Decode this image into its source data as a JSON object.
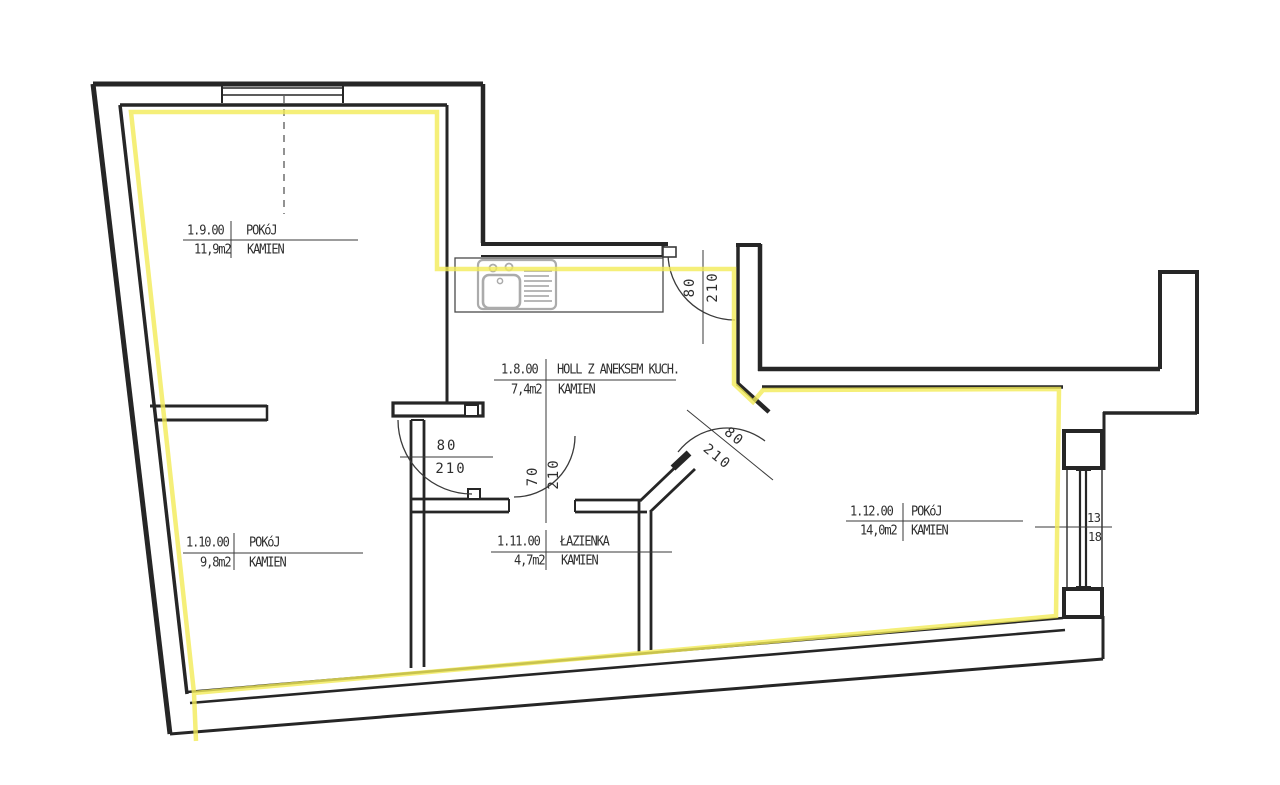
{
  "drawing_type": "apartment floor plan",
  "colors": {
    "wall": "#262626",
    "thin_line": "#3a3a3a",
    "highlight": "#f3eb58",
    "text": "#2e2e2e",
    "fixture": "#ababab"
  },
  "rooms": [
    {
      "id": "1.9.00",
      "name": "POKóJ",
      "area": "11,9m2",
      "material": "KAMIEN"
    },
    {
      "id": "1.10.00",
      "name": "POKóJ",
      "area": "9,8m2",
      "material": "KAMIEN"
    },
    {
      "id": "1.8.00",
      "name": "HOLL Z ANEKSEM KUCH.",
      "area": "7,4m2",
      "material": "KAMIEN"
    },
    {
      "id": "1.11.00",
      "name": "ŁAZIENKA",
      "area": "4,7m2",
      "material": "KAMIEN"
    },
    {
      "id": "1.12.00",
      "name": "POKóJ",
      "area": "14,0m2",
      "material": "KAMIEN"
    }
  ],
  "doors": [
    {
      "id": "entrance-door",
      "width": "80",
      "height": "210"
    },
    {
      "id": "room-1-10-door",
      "width": "80",
      "height": "210"
    },
    {
      "id": "bathroom-door",
      "width": "70",
      "height": "210"
    },
    {
      "id": "room-1-12-door",
      "width": "80",
      "height": "210"
    }
  ],
  "window_dim": {
    "top": "13",
    "bottom": "18"
  }
}
